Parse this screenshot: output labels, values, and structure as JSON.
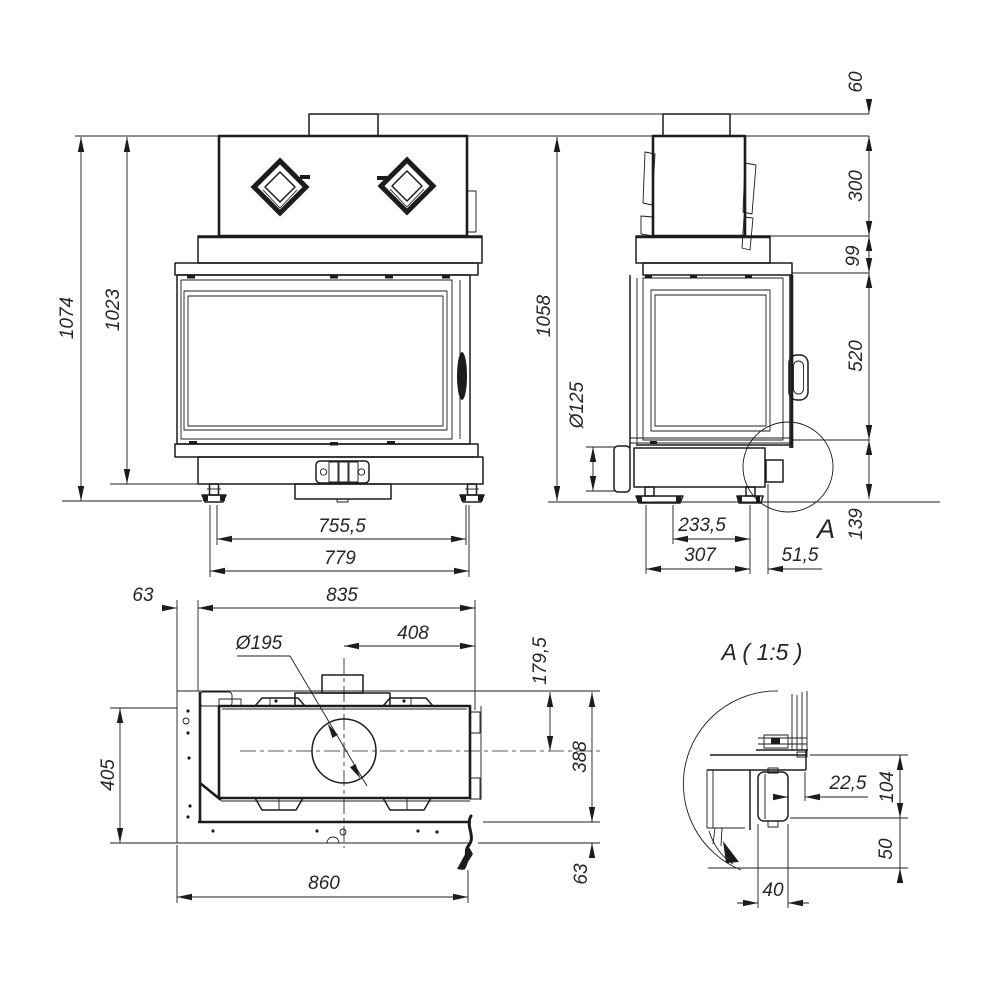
{
  "front": {
    "h_total": "1074",
    "h_inner": "1023",
    "w_feet": "755,5",
    "w_base": "779"
  },
  "side": {
    "h_stub": "60",
    "h_upper": "300",
    "h_band": "99",
    "h_window": "520",
    "h_base": "139",
    "h_total": "1058",
    "dia_outlet": "Ø125",
    "d_feet": "233,5",
    "d_total": "307",
    "d_front": "51,5",
    "detail_mark": "A"
  },
  "top": {
    "lip_front": "63",
    "w_body": "835",
    "dia_flue": "Ø195",
    "flue_from_right": "408",
    "flue_from_front": "179,5",
    "d_body": "388",
    "lip_back": "63",
    "d_frame": "405",
    "w_frame": "860"
  },
  "detail": {
    "title": "A ( 1:5 )",
    "gap": "22,5",
    "h_base": "104",
    "h_feet": "50",
    "w_connector": "40"
  }
}
